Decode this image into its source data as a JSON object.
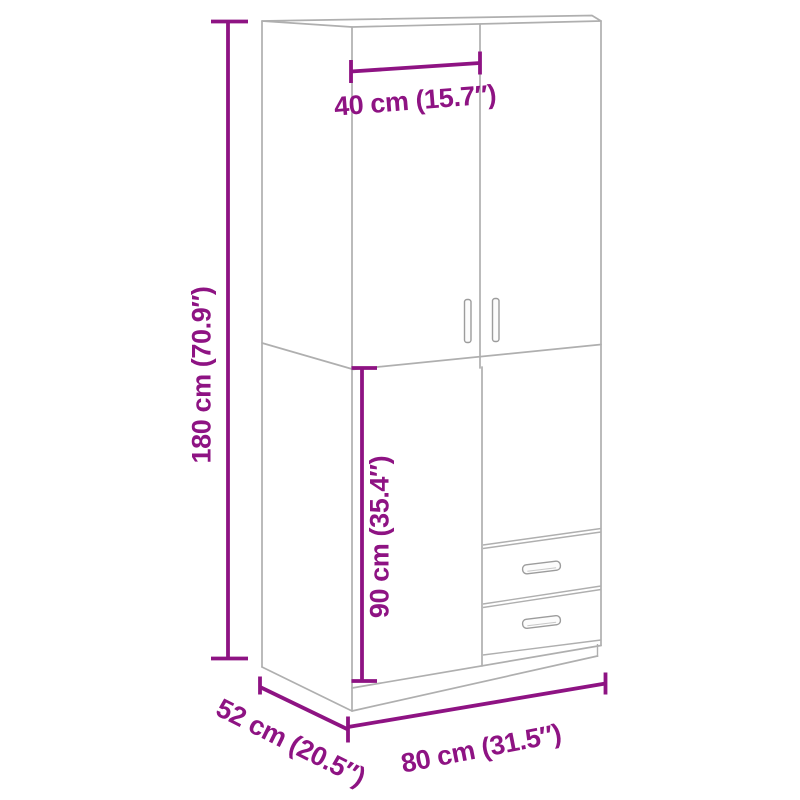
{
  "diagram": {
    "title": "wardrobe-dimension-diagram",
    "dimensions": {
      "overall_height": {
        "label": "180 cm (70.9″)",
        "cm": 180,
        "inches": 70.9
      },
      "door_width": {
        "label": "40 cm (15.7″)",
        "cm": 40,
        "inches": 15.7
      },
      "lower_section_height": {
        "label": "90 cm (35.4″)",
        "cm": 90,
        "inches": 35.4
      },
      "overall_depth": {
        "label": "52 cm (20.5″)",
        "cm": 52,
        "inches": 20.5
      },
      "overall_width": {
        "label": "80 cm (31.5″)",
        "cm": 80,
        "inches": 31.5
      }
    },
    "colors": {
      "dimension_accent": "#8E1383",
      "structure_line": "#AFAFAF",
      "handle_line": "#9C9C9C",
      "background": "#FFFFFF"
    }
  }
}
